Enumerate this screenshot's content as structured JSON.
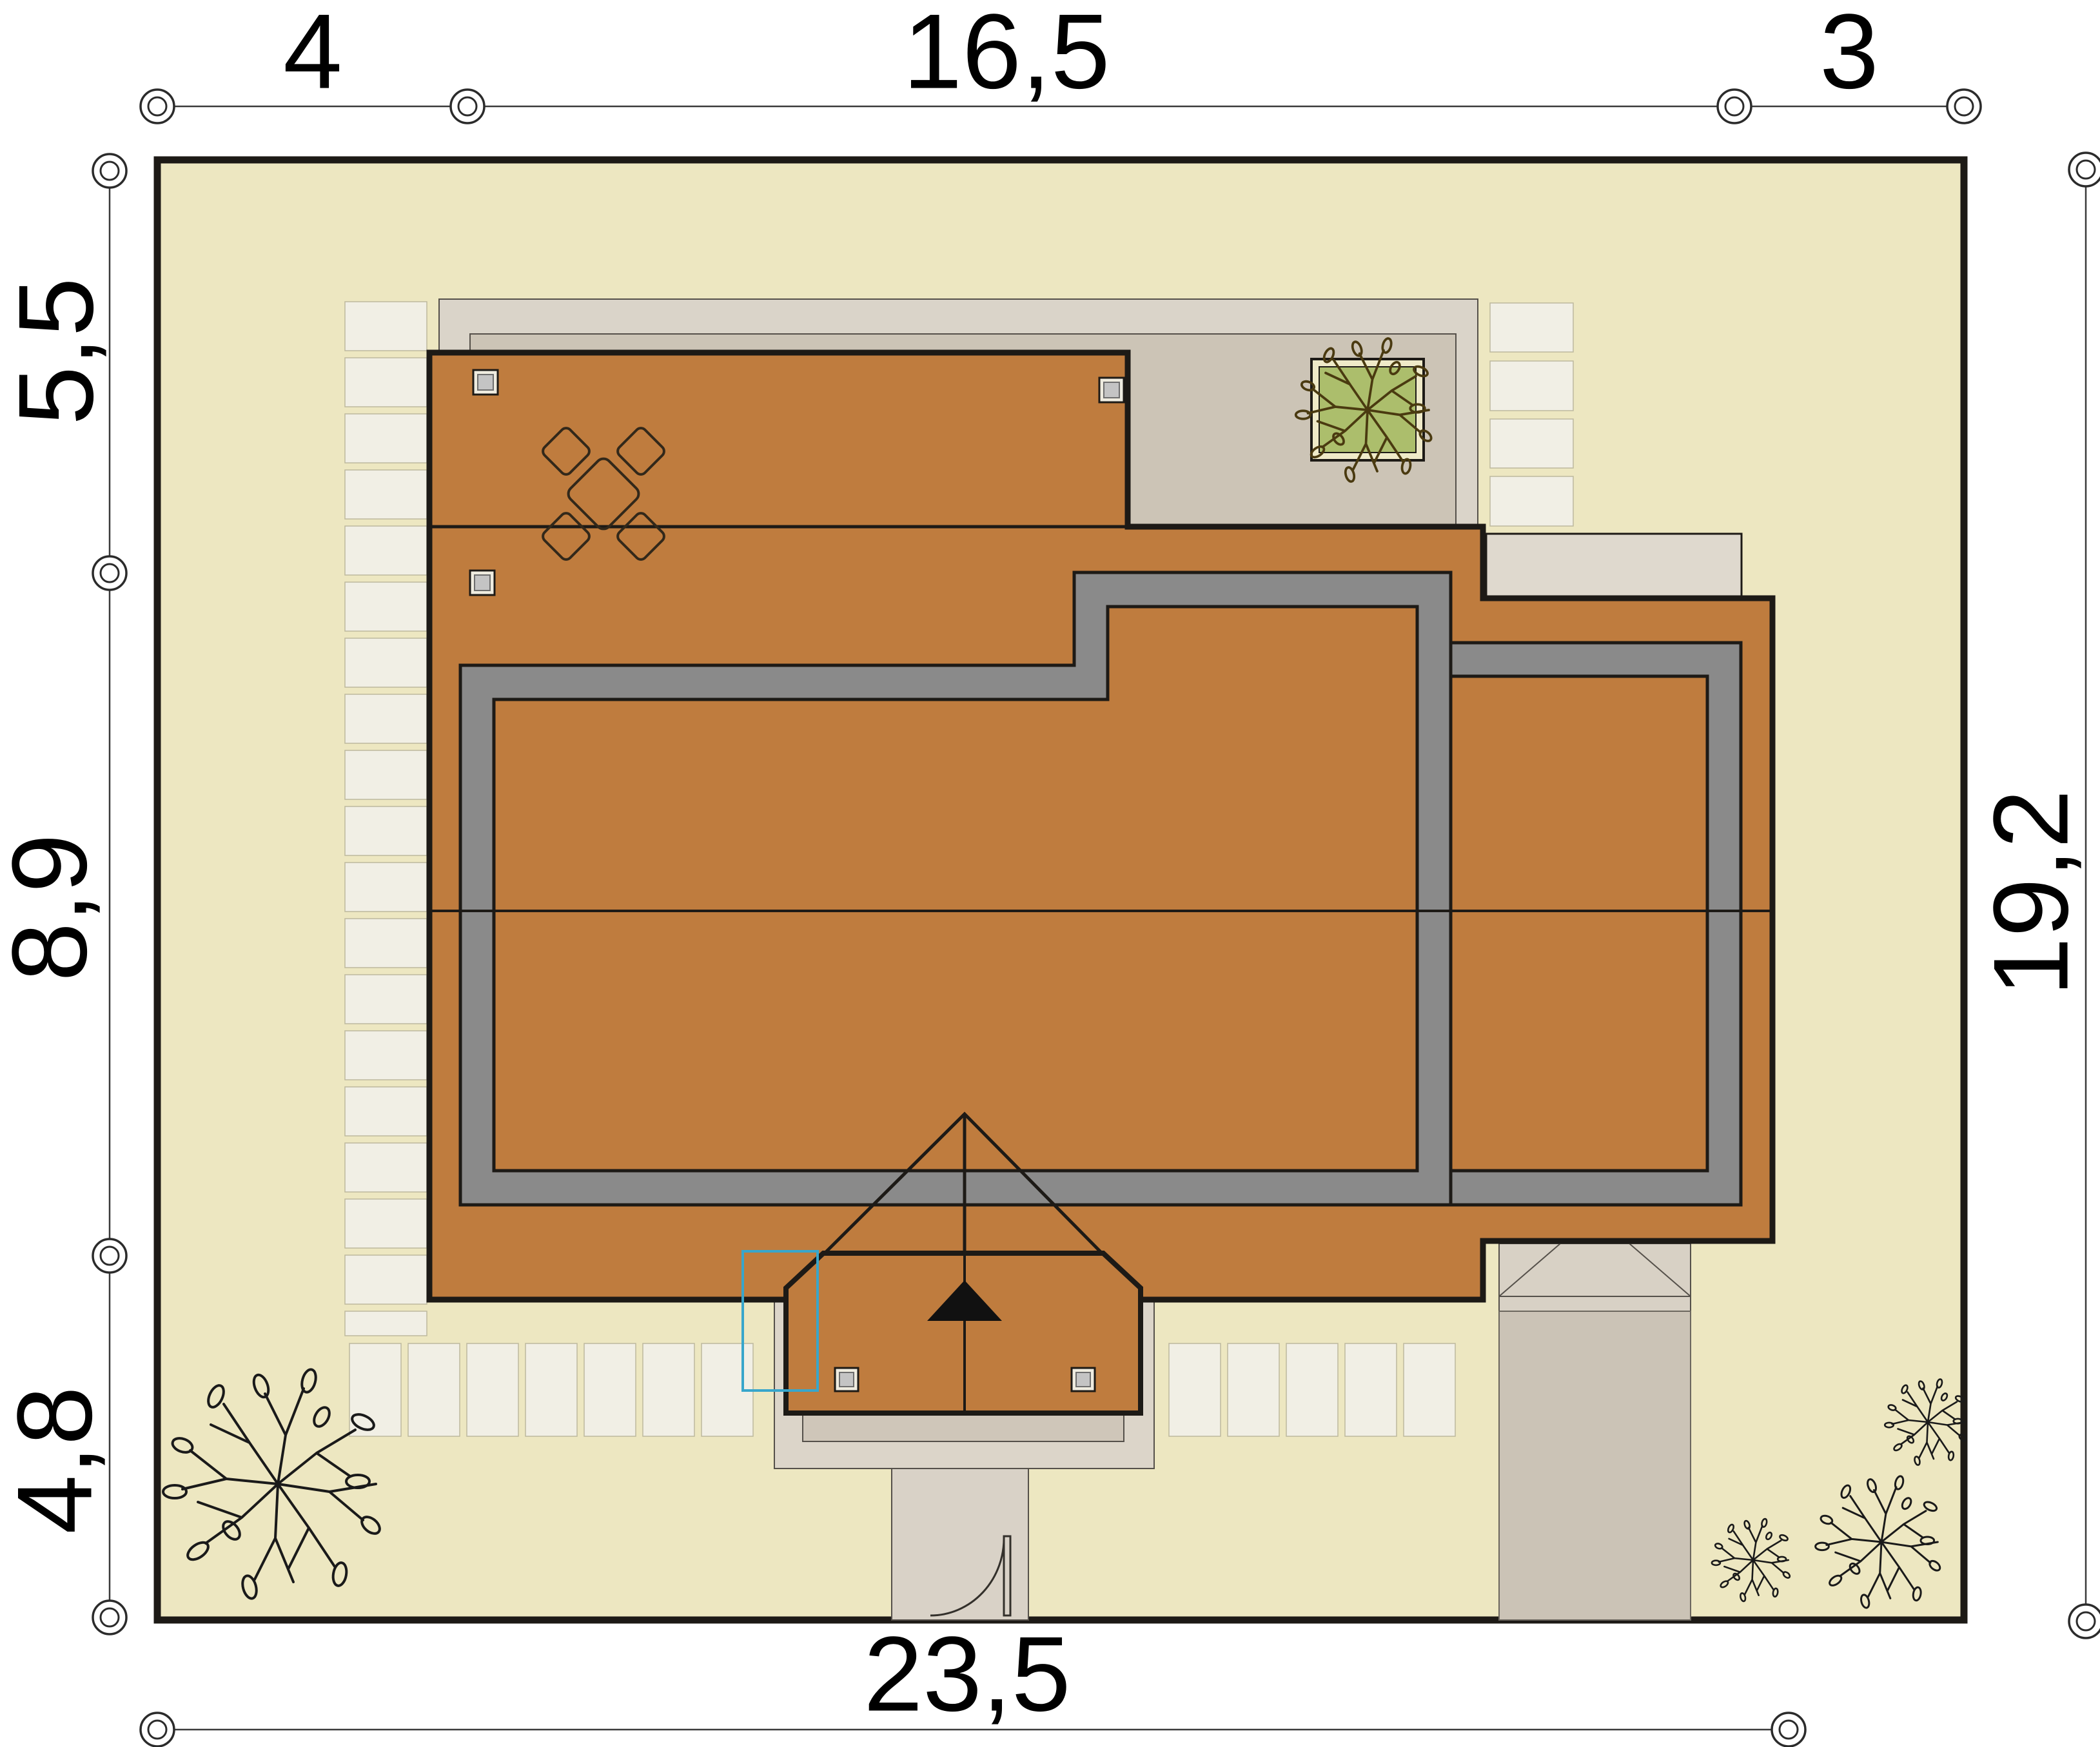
{
  "plan_type": "house-site-plan",
  "dims": {
    "top": [
      "4",
      "16,5",
      "3"
    ],
    "left": [
      "5,5",
      "8,9",
      "4,8"
    ],
    "right": [
      "19,2"
    ],
    "bottom": [
      "23,5"
    ]
  },
  "colors": {
    "plot_grass": "#EDE7C1",
    "roof": "#BF7C3E",
    "roof_outline": "#1D1A16",
    "gutter_band": "#8A8A8A",
    "terrace_outer": "#DAD4C9",
    "terrace_inner": "#CCC4B6",
    "paving_slab": "#F1EFE5",
    "porch_apron": "#DCD5C9",
    "porch_apron_inner": "#CFC6B9",
    "walkway": "#D9D2C7",
    "driveway": "#CBC3B6",
    "garage_canopy": "#D8D1C5",
    "side_patio": "#DFD9CE",
    "planter_green": "#ACBE6C",
    "highlight_cyan": "#38A6CB"
  }
}
